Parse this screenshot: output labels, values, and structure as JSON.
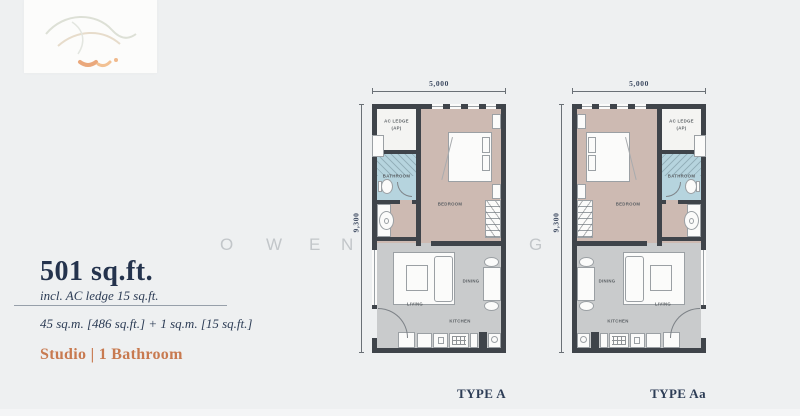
{
  "page": {
    "bg": "#eef0f1"
  },
  "watermark": {
    "letters": [
      {
        "ch": "O",
        "x": 220
      },
      {
        "ch": "W",
        "x": 266
      },
      {
        "ch": "E",
        "x": 309
      },
      {
        "ch": "N",
        "x": 341
      },
      {
        "ch": "G",
        "x": 529
      }
    ]
  },
  "info": {
    "area": "501 sq.ft.",
    "note": "incl. AC ledge 15 sq.ft.",
    "metric": "45 sq.m. [486 sq.ft.] + 1 sq.m. [15 sq.ft.]",
    "config": "Studio | 1 Bathroom"
  },
  "plan": {
    "width_label": "5,000",
    "height_label": "9,300",
    "rooms": {
      "ac_line1": "AC LEDGE",
      "ac_line2": "(AP)",
      "bathroom": "BATHROOM",
      "bedroom": "BEDROOM",
      "living": "LIVING",
      "dining": "DINING",
      "kitchen": "KITCHEN"
    }
  },
  "types": [
    {
      "label": "TYPE A"
    },
    {
      "label": "TYPE Aa"
    }
  ],
  "colors": {
    "navy": "#24334d",
    "orange": "#c87a50",
    "wall": "#3f444a",
    "bedroom_floor": "#cdbab2",
    "living_floor": "#c9cbcc",
    "bathroom_floor": "#b6d4de"
  }
}
